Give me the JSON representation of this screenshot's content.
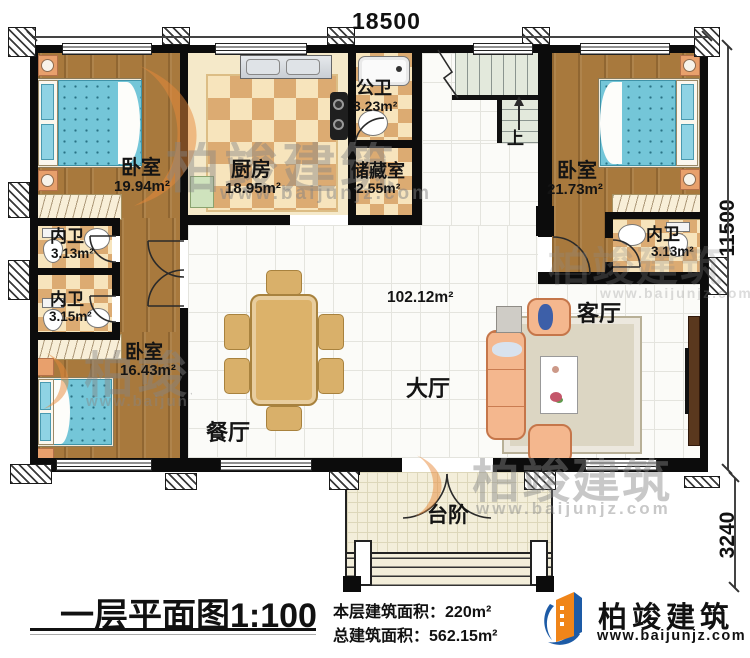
{
  "dimensions": {
    "top": "18500",
    "right": "11500",
    "bottom_right": "3240"
  },
  "stairs_up": "上",
  "rooms": {
    "bedroom_tl": {
      "name": "卧室",
      "area": "19.94m²"
    },
    "kitchen": {
      "name": "厨房",
      "area": "18.95m²"
    },
    "public_bath": {
      "name": "公卫",
      "area": "3.23m²"
    },
    "storage": {
      "name": "储藏室",
      "area": "2.55m²"
    },
    "bedroom_tr": {
      "name": "卧室",
      "area": "21.73m²"
    },
    "bath_right": {
      "name": "内卫",
      "area": "3.13m²"
    },
    "bath_left_upper": {
      "name": "内卫",
      "area": "3.13m²"
    },
    "bath_left_lower": {
      "name": "内卫",
      "area": "3.15m²"
    },
    "bedroom_bl": {
      "name": "卧室",
      "area": "16.43m²"
    },
    "hall": {
      "name": "大厅",
      "area": "102.12m²"
    },
    "living": {
      "name": "客厅"
    },
    "dining": {
      "name": "餐厅"
    },
    "steps": {
      "name": "台阶"
    }
  },
  "title_block": {
    "title": "一层平面图",
    "scale": "1:100",
    "floor_area_label": "本层建筑面积：",
    "floor_area_value": "220m²",
    "total_area_label": "总建筑面积：",
    "total_area_value": "562.15m²"
  },
  "brand": {
    "name": "柏竣建筑",
    "website": "www.baijunjz.com"
  },
  "watermark": {
    "name": "柏竣建筑",
    "website": "www.baijunjz.com"
  }
}
